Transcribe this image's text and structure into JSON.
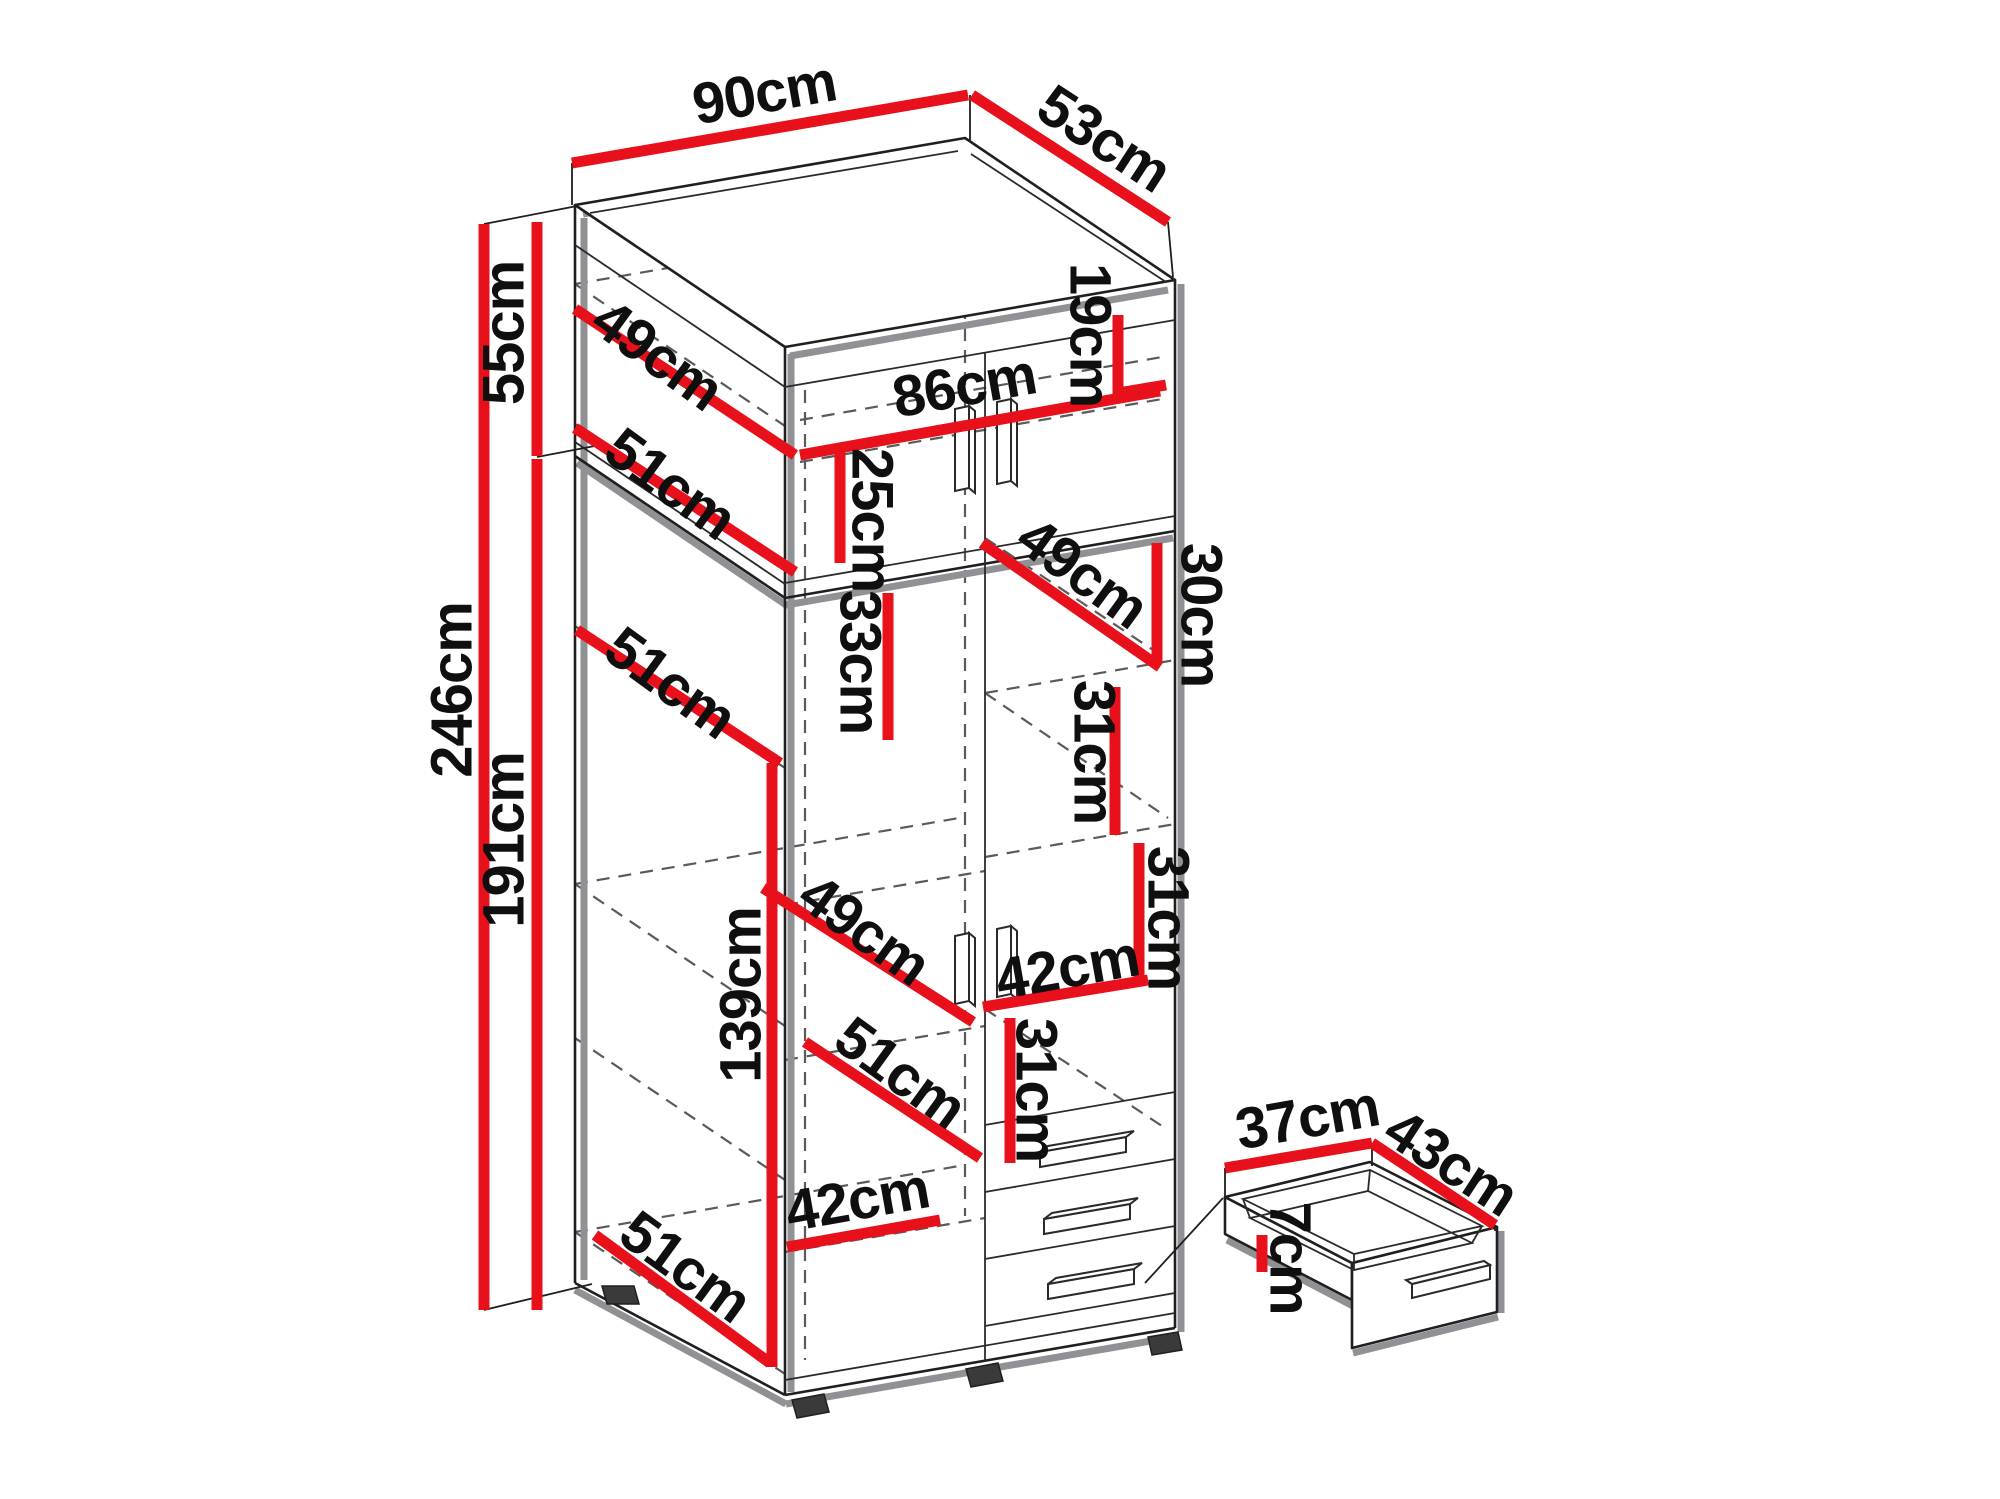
{
  "diagram": {
    "type": "furniture-dimension-drawing",
    "subject": "two-door wardrobe with top cabinet and drawers, plus separate drawer detail",
    "unit": "cm"
  },
  "colors": {
    "dimension_line": "#e8101b",
    "outline": "#1f1f1f",
    "accent_gray": "#909194",
    "label_text": "#0f0f0f",
    "background": "#ffffff"
  },
  "overall_dimensions": {
    "width": "90cm",
    "depth": "53cm",
    "total_height": "246cm",
    "upper_section_height": "55cm",
    "lower_section_height": "191cm"
  },
  "drawer_detail_dimensions": {
    "width": "37cm",
    "depth": "43cm",
    "height": "7cm"
  },
  "dimension_labels": [
    {
      "id": "width-top",
      "text": "90cm",
      "x": 765,
      "y": 97,
      "rot": -10
    },
    {
      "id": "depth-top",
      "text": "53cm",
      "x": 1102,
      "y": 142,
      "rot": 33
    },
    {
      "id": "upper-height",
      "text": "55cm",
      "x": 508,
      "y": 333,
      "rot": -90
    },
    {
      "id": "total-height",
      "text": "246cm",
      "x": 456,
      "y": 690,
      "rot": -90
    },
    {
      "id": "lower-height",
      "text": "191cm",
      "x": 508,
      "y": 840,
      "rot": -90
    },
    {
      "id": "top-shelf-depth",
      "text": "49cm",
      "x": 655,
      "y": 358,
      "rot": 36
    },
    {
      "id": "top-shelf-depth-2",
      "text": "51cm",
      "x": 668,
      "y": 487,
      "rot": 36
    },
    {
      "id": "interior-width",
      "text": "86cm",
      "x": 965,
      "y": 390,
      "rot": -10
    },
    {
      "id": "top-interior-h",
      "text": "25cm",
      "x": 868,
      "y": 520,
      "rot": 90
    },
    {
      "id": "top-right-h",
      "text": "19cm",
      "x": 1086,
      "y": 335,
      "rot": 90
    },
    {
      "id": "mid-shelf-depth",
      "text": "51cm",
      "x": 668,
      "y": 686,
      "rot": 36
    },
    {
      "id": "mid-h-33",
      "text": "33cm",
      "x": 856,
      "y": 662,
      "rot": 90
    },
    {
      "id": "right-shelf-depth",
      "text": "49cm",
      "x": 1080,
      "y": 576,
      "rot": 36
    },
    {
      "id": "right-h-30",
      "text": "30cm",
      "x": 1197,
      "y": 615,
      "rot": 90
    },
    {
      "id": "right-h-31a",
      "text": "31cm",
      "x": 1090,
      "y": 752,
      "rot": 90
    },
    {
      "id": "left-shelf-depth-49",
      "text": "49cm",
      "x": 862,
      "y": 933,
      "rot": 36
    },
    {
      "id": "right-h-31b",
      "text": "31cm",
      "x": 1164,
      "y": 918,
      "rot": 90
    },
    {
      "id": "left-interior-h",
      "text": "139cm",
      "x": 745,
      "y": 995,
      "rot": -90
    },
    {
      "id": "right-shelf-w",
      "text": "42cm",
      "x": 1068,
      "y": 972,
      "rot": -10
    },
    {
      "id": "left-shelf-depth-51",
      "text": "51cm",
      "x": 898,
      "y": 1076,
      "rot": 36
    },
    {
      "id": "right-h-31c",
      "text": "31cm",
      "x": 1032,
      "y": 1090,
      "rot": 90
    },
    {
      "id": "left-shelf-w",
      "text": "42cm",
      "x": 858,
      "y": 1204,
      "rot": -10
    },
    {
      "id": "bottom-depth",
      "text": "51cm",
      "x": 683,
      "y": 1270,
      "rot": 36
    },
    {
      "id": "drawer-width",
      "text": "37cm",
      "x": 1308,
      "y": 1122,
      "rot": -10
    },
    {
      "id": "drawer-depth",
      "text": "43cm",
      "x": 1449,
      "y": 1166,
      "rot": 33
    },
    {
      "id": "drawer-height",
      "text": "7cm",
      "x": 1286,
      "y": 1258,
      "rot": 90
    }
  ],
  "dimension_lines": [
    {
      "id": "width-top",
      "x1": 572,
      "y1": 163,
      "x2": 968,
      "y2": 95
    },
    {
      "id": "depth-top",
      "x1": 972,
      "y1": 95,
      "x2": 1168,
      "y2": 222
    },
    {
      "id": "total-height",
      "x1": 484,
      "y1": 224,
      "x2": 484,
      "y2": 1310
    },
    {
      "id": "upper-height",
      "x1": 537,
      "y1": 222,
      "x2": 537,
      "y2": 456
    },
    {
      "id": "lower-height",
      "x1": 537,
      "y1": 459,
      "x2": 537,
      "y2": 1310
    },
    {
      "id": "top-shelf-49",
      "x1": 575,
      "y1": 309,
      "x2": 795,
      "y2": 455
    },
    {
      "id": "top-shelf-51",
      "x1": 575,
      "y1": 428,
      "x2": 795,
      "y2": 572
    },
    {
      "id": "interior-86",
      "x1": 800,
      "y1": 455,
      "x2": 1160,
      "y2": 391
    },
    {
      "id": "top-25",
      "x1": 840,
      "y1": 452,
      "x2": 840,
      "y2": 563
    },
    {
      "id": "top-19",
      "x1": 1118,
      "y1": 315,
      "x2": 1118,
      "y2": 397
    },
    {
      "id": "top-19-tick",
      "x1": 1118,
      "y1": 393,
      "x2": 1166,
      "y2": 385
    },
    {
      "id": "mid-shelf-51",
      "x1": 577,
      "y1": 630,
      "x2": 780,
      "y2": 763
    },
    {
      "id": "mid-33",
      "x1": 888,
      "y1": 593,
      "x2": 888,
      "y2": 740
    },
    {
      "id": "right-shelf-49",
      "x1": 982,
      "y1": 543,
      "x2": 1160,
      "y2": 667
    },
    {
      "id": "right-30",
      "x1": 1157,
      "y1": 543,
      "x2": 1157,
      "y2": 663
    },
    {
      "id": "right-31a",
      "x1": 1115,
      "y1": 687,
      "x2": 1115,
      "y2": 835
    },
    {
      "id": "left-shelf-49",
      "x1": 763,
      "y1": 888,
      "x2": 973,
      "y2": 1022
    },
    {
      "id": "right-31b",
      "x1": 1139,
      "y1": 843,
      "x2": 1139,
      "y2": 983
    },
    {
      "id": "left-139",
      "x1": 772,
      "y1": 763,
      "x2": 772,
      "y2": 1367
    },
    {
      "id": "right-42",
      "x1": 983,
      "y1": 1007,
      "x2": 1148,
      "y2": 980
    },
    {
      "id": "left-shelf-51",
      "x1": 805,
      "y1": 1042,
      "x2": 980,
      "y2": 1158
    },
    {
      "id": "right-31c",
      "x1": 1010,
      "y1": 1018,
      "x2": 1010,
      "y2": 1163
    },
    {
      "id": "left-42",
      "x1": 787,
      "y1": 1247,
      "x2": 940,
      "y2": 1220
    },
    {
      "id": "bottom-51",
      "x1": 595,
      "y1": 1235,
      "x2": 770,
      "y2": 1363
    },
    {
      "id": "drawer-37",
      "x1": 1225,
      "y1": 1168,
      "x2": 1372,
      "y2": 1143
    },
    {
      "id": "drawer-43",
      "x1": 1372,
      "y1": 1143,
      "x2": 1495,
      "y2": 1225
    },
    {
      "id": "drawer-7",
      "x1": 1262,
      "y1": 1235,
      "x2": 1262,
      "y2": 1272
    }
  ]
}
